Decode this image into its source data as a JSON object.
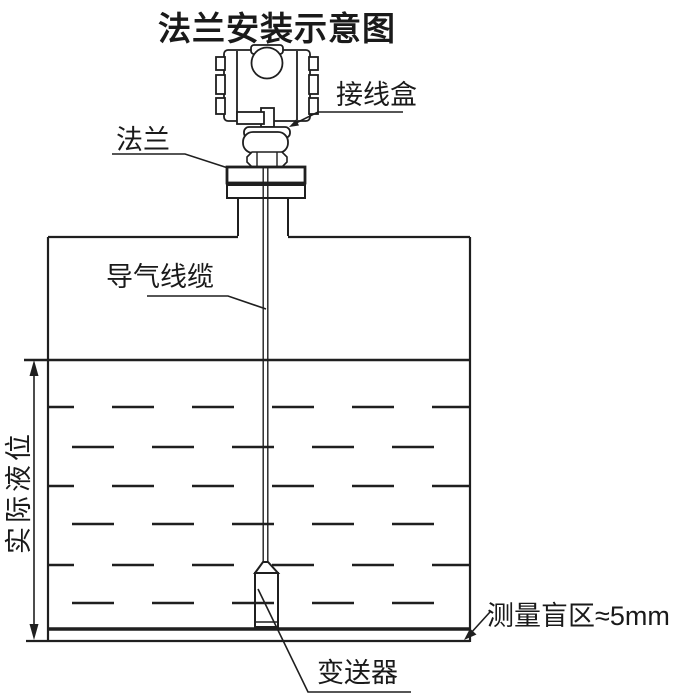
{
  "title": "法兰安装示意图",
  "labels": {
    "junction_box": "接线盒",
    "flange": "法兰",
    "air_cable": "导气线缆",
    "actual_level": "实际液位",
    "transmitter": "变送器",
    "blind_zone": "测量盲区≈5mm"
  },
  "colors": {
    "line": "#1f1f1f",
    "background": "#ffffff",
    "text": "#1a1a1a"
  }
}
